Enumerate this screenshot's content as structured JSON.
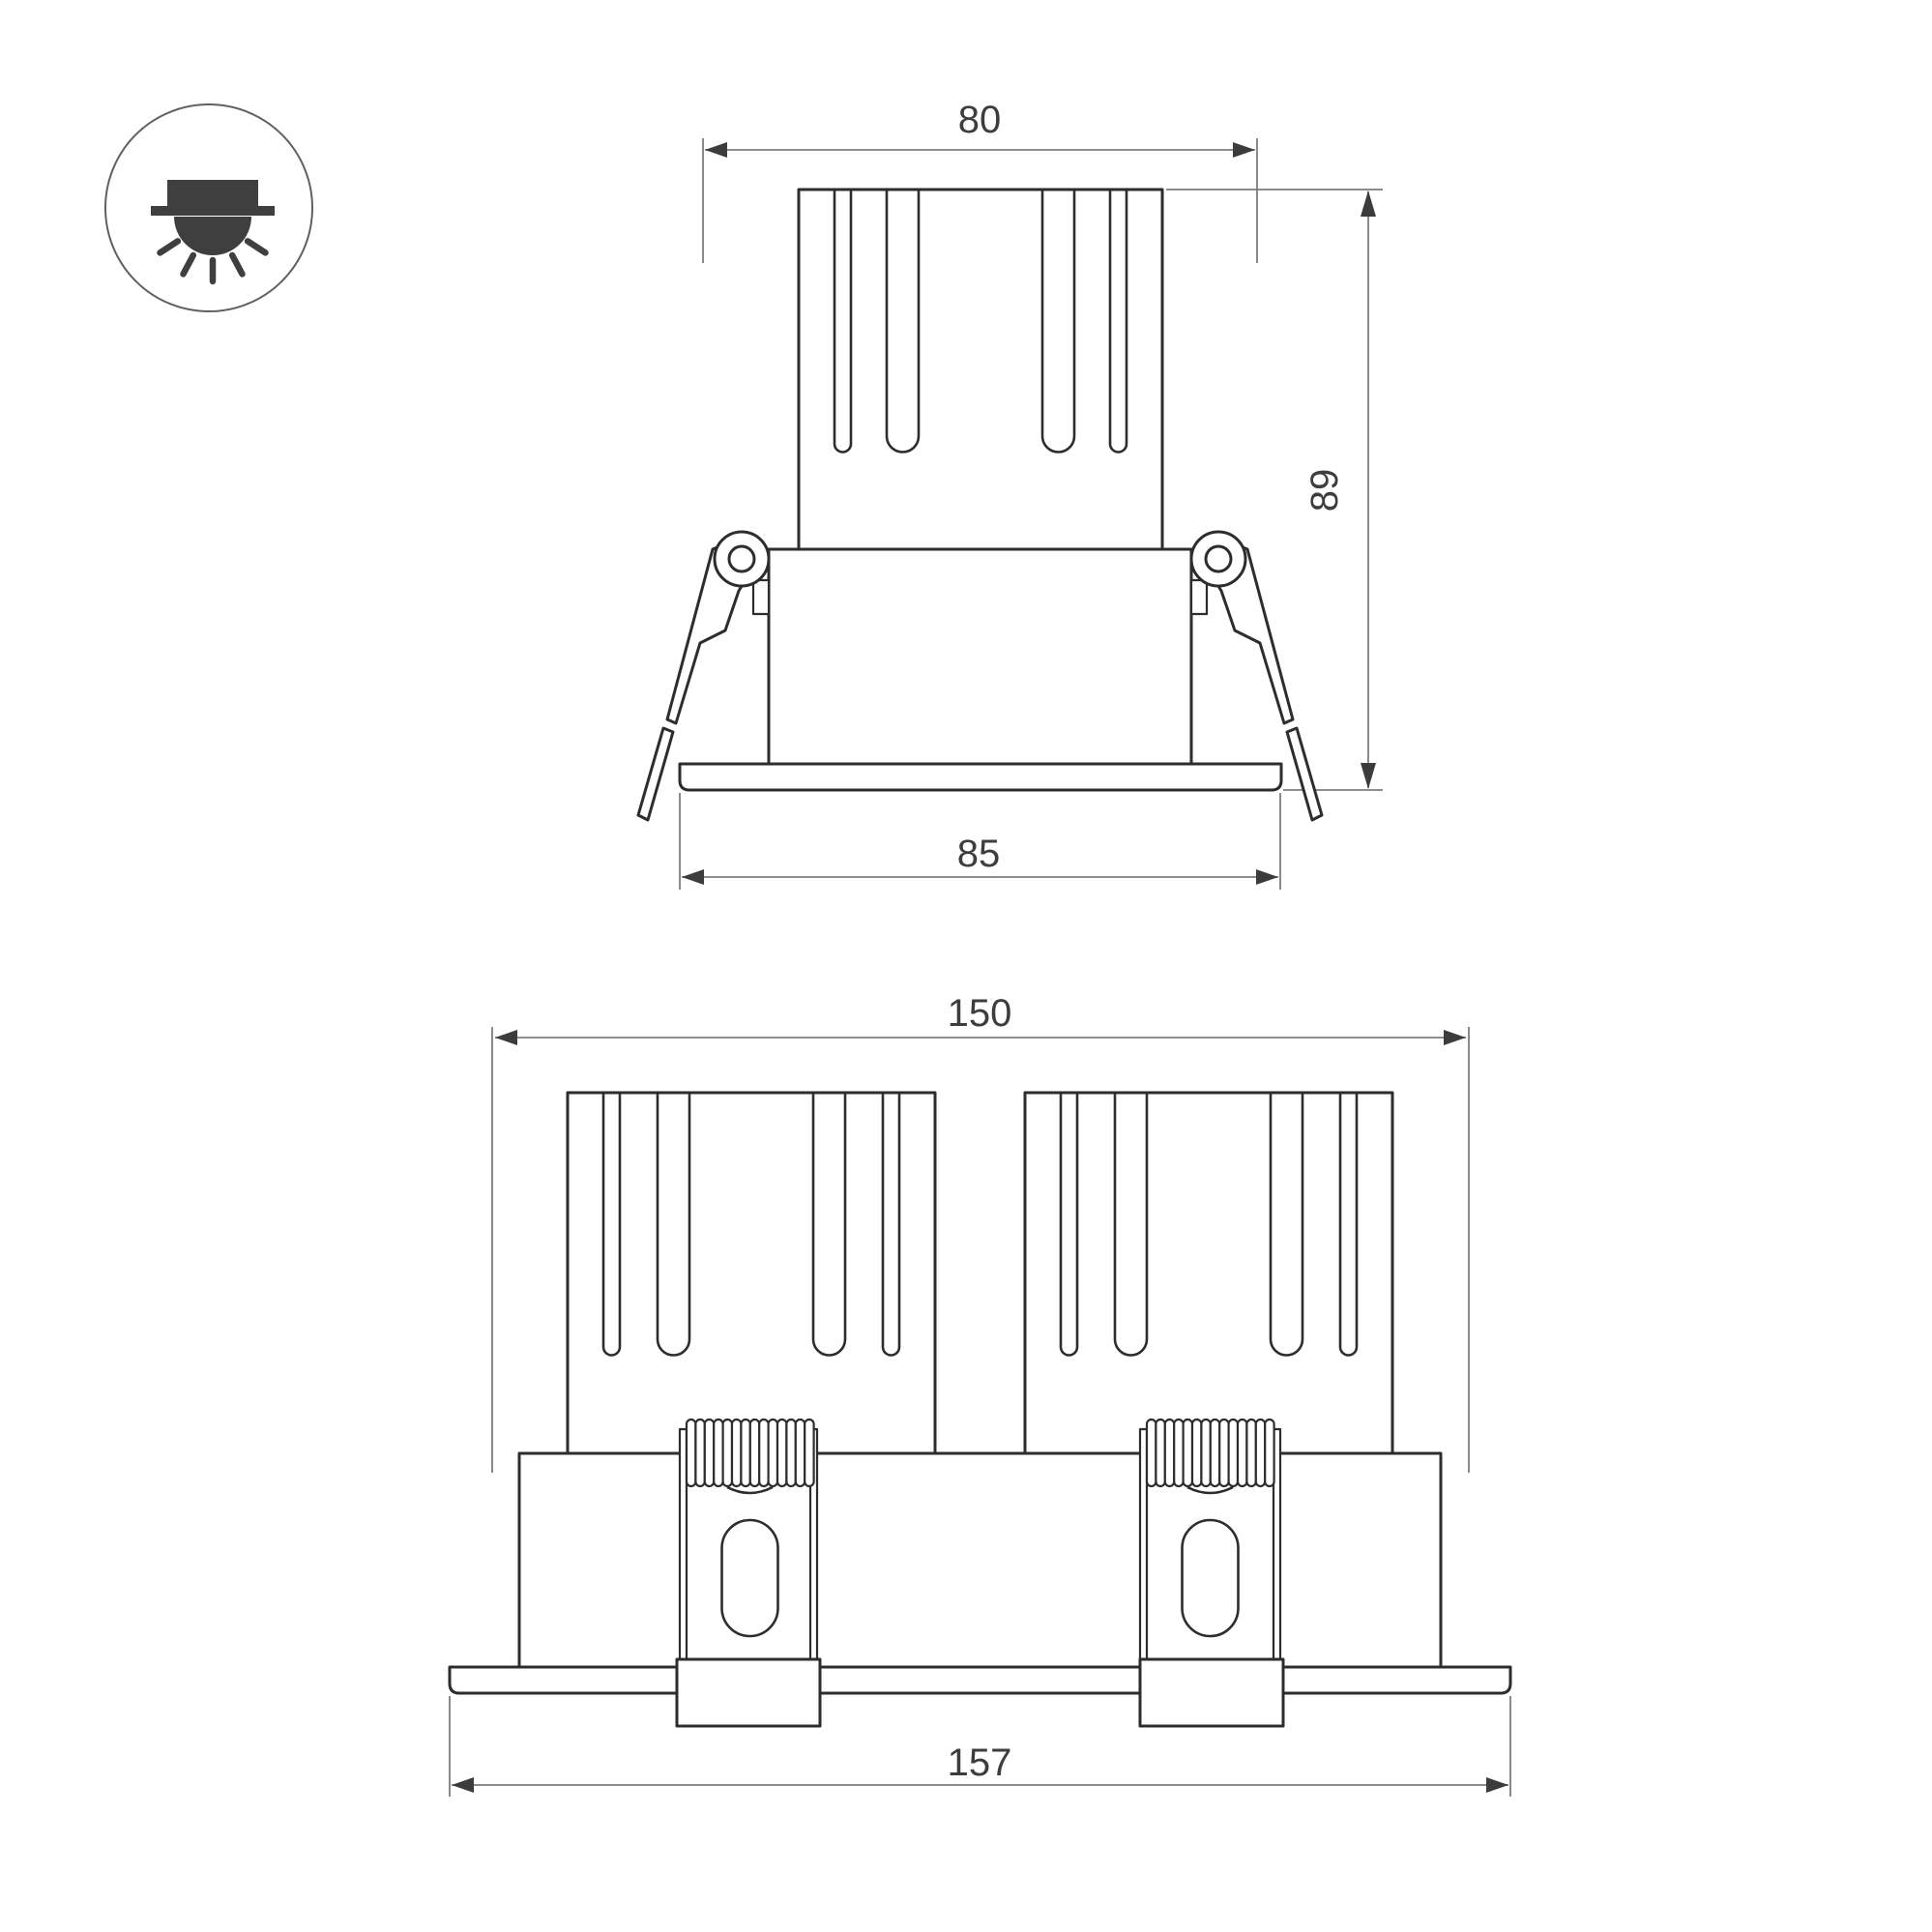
{
  "drawing": {
    "icon": {
      "label": "recessed-downlight"
    },
    "single_view": {
      "dim_width_top": "80",
      "dim_height": "89",
      "dim_width_flange": "85"
    },
    "double_view": {
      "dim_width_top": "150",
      "dim_width_flange": "157"
    }
  },
  "colors": {
    "background": "#ffffff",
    "outline": "#2d2d2d",
    "dimension_line": "#7d7d7d",
    "dimension_text": "#3d3d3d",
    "icon_fill": "#3f3f3f"
  }
}
